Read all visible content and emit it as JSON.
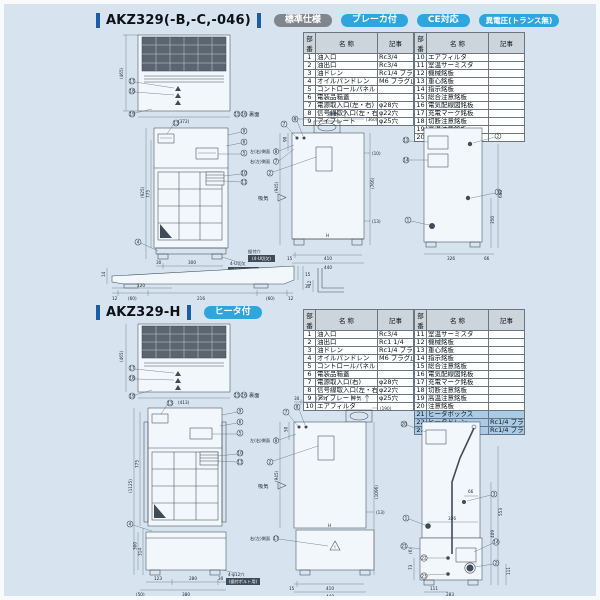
{
  "common": {
    "table_headers": [
      "部番",
      "名  称",
      "記事"
    ]
  },
  "s1": {
    "title": "AKZ329(-B,-C,-046)",
    "badges": [
      {
        "label": "標準仕様",
        "color": "#81868c"
      },
      {
        "label": "ブレーカ付",
        "color": "#2ea6dd"
      },
      {
        "label": "CE対応",
        "color": "#2ea6dd"
      },
      {
        "label": "異電圧(トランス無)",
        "color": "#2ea6dd"
      }
    ],
    "parts_left": [
      {
        "no": "1",
        "name": "油入口",
        "note": "Rc3/4"
      },
      {
        "no": "2",
        "name": "油出口",
        "note": "Rc3/4"
      },
      {
        "no": "3",
        "name": "油ドレン",
        "note": "Rc1/4 プラグ止メ"
      },
      {
        "no": "4",
        "name": "オイルパンドレン",
        "note": "M6 プラグ止メ"
      },
      {
        "no": "5",
        "name": "コントロールパネル",
        "note": ""
      },
      {
        "no": "6",
        "name": "電装品箱蓋",
        "note": ""
      },
      {
        "no": "7",
        "name": "電源取入口(左・右)",
        "note": "φ28穴"
      },
      {
        "no": "8",
        "name": "信号線取入口(左・右)",
        "note": "φ22穴"
      },
      {
        "no": "9",
        "name": "アイプレート",
        "note": "φ25穴"
      }
    ],
    "parts_right": [
      {
        "no": "10",
        "name": "エアフィルタ",
        "note": ""
      },
      {
        "no": "11",
        "name": "室温サーミスタ",
        "note": ""
      },
      {
        "no": "12",
        "name": "機械銘板",
        "note": ""
      },
      {
        "no": "13",
        "name": "重心銘板",
        "note": ""
      },
      {
        "no": "14",
        "name": "指示銘板",
        "note": ""
      },
      {
        "no": "15",
        "name": "総合注意銘板",
        "note": ""
      },
      {
        "no": "16",
        "name": "電気配線図銘板",
        "note": ""
      },
      {
        "no": "17",
        "name": "充電マーク銘板",
        "note": ""
      },
      {
        "no": "18",
        "name": "切断注意銘板",
        "note": ""
      },
      {
        "no": "19",
        "name": "高温注意銘板",
        "note": ""
      },
      {
        "no": "20",
        "name": "注意銘板",
        "note": ""
      }
    ],
    "top": {
      "dim_h": "(465)",
      "dim_w": "(372)",
      "c17": "17",
      "c18": "18",
      "c19": "19",
      "b15": "15",
      "b16": "16",
      "back_label": "裏面"
    },
    "front": {
      "dim_h1": "(925)",
      "dim_h2": "775",
      "b1": "30",
      "b2": "300",
      "b3": "340",
      "c13": "13",
      "c9": "9",
      "c6": "6",
      "c5": "5",
      "c10": "10",
      "c11": "11",
      "c4": "4",
      "note1": "4-U切欠",
      "note2": "(据付穴用)"
    },
    "side": {
      "t1": "(360)",
      "l90": "90",
      "lh": "(945)",
      "rh": "(766)",
      "r10": "(10)",
      "r13": "(13)",
      "b15": "15",
      "b410": "410",
      "b440": "440",
      "h": "H",
      "exhaust": "排気",
      "intake": "吸気",
      "c7": "7",
      "c8": "8",
      "lbl_left": "左(右)側面",
      "lbl_left_n": "8",
      "lbl_right": "右(左)側面",
      "lbl_right_n": "7",
      "c2": "2",
      "note1": "据付穴",
      "note2": "(4-U切欠)"
    },
    "rear": {
      "c12": "12",
      "c14": "14",
      "p1": "1",
      "p2": "2",
      "p3": "3",
      "v1": "640",
      "v2": "350",
      "b1": "326",
      "b2": "66"
    },
    "base": {
      "l14": "14",
      "t120": "120",
      "d1": "12",
      "d2": "(60)",
      "d3": "216",
      "d4": "(60)",
      "d5": "12",
      "r15": "15",
      "r30": "30"
    },
    "bracket": {
      "d12": "12"
    }
  },
  "s2": {
    "title": "AKZ329-H",
    "badges": [
      {
        "label": "ヒータ付",
        "color": "#2ea6dd"
      }
    ],
    "parts_left": [
      {
        "no": "1",
        "name": "油入口",
        "note": "Rc3/4"
      },
      {
        "no": "2",
        "name": "油出口",
        "note": "Rc1 1/4"
      },
      {
        "no": "3",
        "name": "油ドレン",
        "note": "Rc1/4 プラグ止メ"
      },
      {
        "no": "4",
        "name": "オイルパンドレン",
        "note": "M6 プラグ止メ"
      },
      {
        "no": "5",
        "name": "コントロールパネル",
        "note": ""
      },
      {
        "no": "6",
        "name": "電装品箱蓋",
        "note": ""
      },
      {
        "no": "7",
        "name": "電源取入口(右)",
        "note": "φ28穴"
      },
      {
        "no": "8",
        "name": "信号線取入口(左・右)",
        "note": "φ22穴"
      },
      {
        "no": "9",
        "name": "アイプレート",
        "note": "φ25穴"
      },
      {
        "no": "10",
        "name": "エアフィルタ",
        "note": ""
      }
    ],
    "parts_right": [
      {
        "no": "11",
        "name": "室温サーミスタ",
        "note": ""
      },
      {
        "no": "12",
        "name": "機械銘板",
        "note": ""
      },
      {
        "no": "13",
        "name": "重心銘板",
        "note": ""
      },
      {
        "no": "14",
        "name": "指示銘板",
        "note": ""
      },
      {
        "no": "15",
        "name": "総合注意銘板",
        "note": ""
      },
      {
        "no": "16",
        "name": "電気配線図銘板",
        "note": ""
      },
      {
        "no": "17",
        "name": "充電マーク銘板",
        "note": ""
      },
      {
        "no": "18",
        "name": "切断注意銘板",
        "note": ""
      },
      {
        "no": "19",
        "name": "高温注意銘板",
        "note": ""
      },
      {
        "no": "20",
        "name": "注意銘板",
        "note": ""
      },
      {
        "no": "21",
        "name": "ヒータボックス",
        "note": "",
        "hl": true
      },
      {
        "no": "22",
        "name": "ヒータドレン",
        "note": "Rc1/4 プラグ止メ",
        "hl": true
      },
      {
        "no": "23",
        "name": "エア抜キ",
        "note": "Rc1/4 プラグ止メ",
        "hl": true
      }
    ],
    "top": {
      "dim_h": "(465)",
      "dim_w": "(413)",
      "c17": "17",
      "c18": "18",
      "c19": "19",
      "b15": "15",
      "b16": "16",
      "back_label": "裏面"
    },
    "front": {
      "dim_h1": "(1125)",
      "dim_h2": "775",
      "dim_h3": "300",
      "dim_h4": "314",
      "b1": "123",
      "b2": "280",
      "b3": "30",
      "b4": "(50)",
      "b5": "380",
      "c13": "13",
      "c9": "9",
      "c6": "6",
      "c5": "5",
      "c10": "10",
      "c11": "11",
      "c4": "4",
      "note1": "4-φ12穴",
      "note2": "(据付ボルト用)"
    },
    "side": {
      "t30": "30",
      "t1": "(365)",
      "t2": "(190)",
      "l50": "50",
      "lh": "(945)",
      "rh": "(1096)",
      "r13": "(13)",
      "b15": "15",
      "b410": "410",
      "b440": "440",
      "h": "H",
      "exhaust": "排気",
      "intake": "吸気",
      "c7": "7",
      "c8": "8",
      "lbl_left": "左(右)側面",
      "lbl_left_n": "8",
      "c2": "2",
      "lbl_heater": "右(左)側面",
      "lbl_heater_n": "17",
      "warn": "!"
    },
    "rear": {
      "c20": "20",
      "c3": "3",
      "d66": "66",
      "c1": "1",
      "d326": "326",
      "c21": "21",
      "c14": "14",
      "c2": "2",
      "c22": "22",
      "c23": "23",
      "v1": "553",
      "v2": "409",
      "v3": "111",
      "l6": "(6)",
      "l73": "73",
      "b1": "111",
      "b2": "283"
    }
  }
}
